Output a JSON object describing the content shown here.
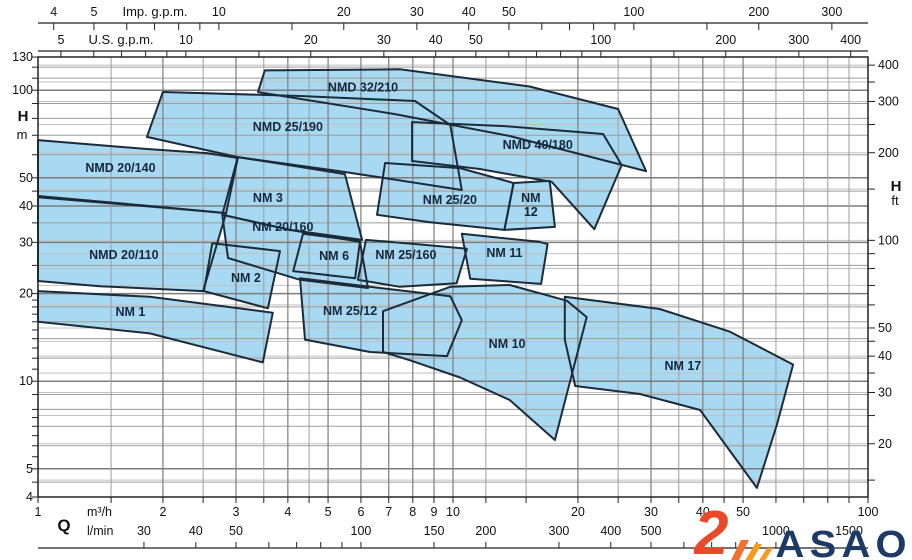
{
  "logo": {
    "brand": "ASAO",
    "numeral": "2",
    "color_navy": "#1d3a66",
    "color_orange": "#e8492b",
    "color_orange_light": "#f59c20"
  },
  "chart_data": {
    "type": "area",
    "title": "Pump selection chart NM / NMD series (head H vs flow Q, log-log)",
    "colors": {
      "region_fill": "#a7daf2",
      "region_stroke": "#1c2b3a",
      "label_color": "#16283e",
      "grid_major": "#7c7c7c",
      "grid_minor": "#9d9d9d",
      "grid_faint": "#c2c2c2",
      "axis_color": "#222222",
      "text_color": "#111111"
    },
    "axes": {
      "top1": {
        "label": "Imp. g.p.m.",
        "factor_m3h": 0.27277,
        "ticks": [
          4,
          5,
          6,
          7,
          8,
          9,
          10,
          15,
          20,
          30,
          40,
          50,
          60,
          70,
          80,
          90,
          100,
          150,
          200,
          300
        ],
        "labeled": [
          4,
          5,
          10,
          20,
          30,
          40,
          50,
          100,
          200,
          300
        ]
      },
      "top2": {
        "label": "U.S. g.p.m.",
        "factor_m3h": 0.22712,
        "ticks": [
          5,
          6,
          7,
          8,
          9,
          10,
          15,
          20,
          30,
          40,
          50,
          60,
          70,
          80,
          90,
          100,
          150,
          200,
          300,
          400
        ],
        "labeled": [
          5,
          10,
          20,
          30,
          40,
          50,
          100,
          200,
          300,
          400
        ]
      },
      "left": {
        "label": "H",
        "unit": "m",
        "range": [
          4,
          130
        ],
        "labeled": [
          130,
          100,
          50,
          40,
          30,
          20,
          10,
          5,
          4
        ],
        "ticks": [
          4,
          4.5,
          5,
          5.5,
          6,
          6.5,
          7,
          7.5,
          8,
          9,
          10,
          11,
          12,
          13,
          14,
          15,
          16,
          17,
          18,
          19,
          20,
          25,
          30,
          35,
          40,
          45,
          50,
          60,
          70,
          80,
          90,
          100,
          110,
          120,
          130
        ]
      },
      "right": {
        "label": "H",
        "unit": "ft",
        "factor_m": 0.3048,
        "labeled": [
          400,
          300,
          200,
          100,
          50,
          40,
          30,
          20
        ],
        "ticks": [
          15,
          20,
          25,
          30,
          35,
          40,
          45,
          50,
          60,
          70,
          80,
          90,
          100,
          150,
          200,
          250,
          300,
          350,
          400
        ]
      },
      "bottom1": {
        "label": "Q",
        "unit": "m³/h",
        "range": [
          1,
          100
        ],
        "labeled": [
          1,
          2,
          3,
          4,
          5,
          6,
          7,
          8,
          9,
          10,
          20,
          30,
          40,
          50,
          100
        ]
      },
      "bottom2": {
        "unit": "l/min",
        "factor_m3h": 0.06,
        "ticks": [
          30,
          40,
          50,
          60,
          70,
          80,
          90,
          100,
          150,
          200,
          300,
          400,
          500,
          600,
          700,
          800,
          900,
          1000,
          1500
        ],
        "labeled": [
          30,
          40,
          50,
          100,
          150,
          200,
          300,
          400,
          500,
          1000,
          1500
        ]
      }
    },
    "grid": {
      "q_major": [
        1,
        2,
        3,
        4,
        5,
        6,
        7,
        8,
        9,
        10,
        20,
        30,
        40,
        50,
        100
      ],
      "q_minor": [
        1.5,
        2.5,
        3.5,
        4.5,
        12,
        15,
        25,
        35,
        45,
        60,
        70,
        80,
        90
      ],
      "h_major": [
        4,
        5,
        10,
        20,
        30,
        40,
        50,
        100
      ],
      "h_minor": [
        4.5,
        6,
        7,
        8,
        9,
        12,
        14,
        16,
        18,
        25,
        35,
        45,
        60,
        70,
        80,
        90,
        110,
        120
      ],
      "ft_lines": [
        15,
        20,
        25,
        30,
        35,
        40,
        45,
        50,
        60,
        70,
        80,
        90,
        100,
        150,
        200,
        250,
        300,
        350,
        400
      ]
    },
    "regions": [
      {
        "label": "NMD 20/140",
        "label_q": 1.58,
        "label_h": 54.0,
        "points": [
          [
            1.0,
            67.4
          ],
          [
            1.83,
            62.8
          ],
          [
            2.55,
            60.8
          ],
          [
            3.03,
            58.5
          ],
          [
            2.84,
            37.8
          ],
          [
            1.86,
            40.0
          ],
          [
            1.0,
            43.3
          ]
        ]
      },
      {
        "label": "NMD 20/110",
        "label_q": 1.61,
        "label_h": 27.1,
        "points": [
          [
            1.0,
            42.9
          ],
          [
            2.3,
            38.8
          ],
          [
            2.84,
            37.8
          ],
          [
            2.5,
            20.4
          ],
          [
            1.41,
            21.2
          ],
          [
            1.0,
            22.1
          ]
        ]
      },
      {
        "label": "NM 1",
        "label_q": 1.67,
        "label_h": 17.3,
        "points": [
          [
            1.0,
            20.4
          ],
          [
            1.86,
            19.5
          ],
          [
            3.68,
            17.2
          ],
          [
            3.48,
            11.6
          ],
          [
            1.86,
            14.6
          ],
          [
            1.0,
            16.0
          ]
        ]
      },
      {
        "label": "NMD 25/190",
        "label_q": 4.0,
        "label_h": 74.7,
        "points": [
          [
            2.0,
            98.6
          ],
          [
            4.28,
            95.5
          ],
          [
            8.1,
            91.8
          ],
          [
            9.85,
            75.9
          ],
          [
            10.5,
            45.4
          ],
          [
            5.34,
            52.7
          ],
          [
            3.03,
            58.9
          ],
          [
            1.83,
            69.1
          ]
        ]
      },
      {
        "label": "NMD 32/210",
        "label_q": 6.07,
        "label_h": 102,
        "points": [
          [
            3.52,
            117
          ],
          [
            7.45,
            118
          ],
          [
            15.3,
            103
          ],
          [
            25.0,
            86.2
          ],
          [
            29.2,
            52.7
          ],
          [
            13.7,
            69.6
          ],
          [
            7.25,
            82.8
          ],
          [
            3.39,
            98.5
          ]
        ]
      },
      {
        "label": "NMD 40/180",
        "label_q": 16.0,
        "label_h": 64.8,
        "points": [
          [
            7.97,
            77.7
          ],
          [
            13.3,
            75.3
          ],
          [
            23.0,
            70.7
          ],
          [
            25.5,
            55.3
          ],
          [
            21.9,
            33.3
          ],
          [
            17.3,
            48.4
          ],
          [
            11.6,
            53.6
          ],
          [
            7.97,
            57.1
          ]
        ]
      },
      {
        "label": "NM 3",
        "label_q": 3.58,
        "label_h": 42.6,
        "points": [
          [
            3.03,
            58.9
          ],
          [
            4.28,
            54.5
          ],
          [
            5.49,
            51.5
          ],
          [
            6.04,
            30.6
          ],
          [
            4.05,
            33.1
          ],
          [
            2.78,
            37.3
          ]
        ]
      },
      {
        "label": "NM 2",
        "label_q": 3.17,
        "label_h": 22.6,
        "points": [
          [
            2.63,
            29.8
          ],
          [
            3.83,
            28.0
          ],
          [
            3.58,
            17.8
          ],
          [
            2.51,
            20.4
          ]
        ]
      },
      {
        "label": "NM 20/160",
        "label_q": 3.89,
        "label_h": 33.9,
        "points": [
          [
            2.78,
            37.3
          ],
          [
            4.05,
            33.1
          ],
          [
            5.97,
            30.1
          ],
          [
            6.24,
            20.9
          ],
          [
            4.28,
            22.3
          ],
          [
            2.87,
            26.5
          ]
        ]
      },
      {
        "label": "NM 6",
        "label_q": 5.17,
        "label_h": 26.9,
        "points": [
          [
            4.35,
            32.1
          ],
          [
            5.97,
            30.3
          ],
          [
            5.81,
            22.6
          ],
          [
            4.12,
            23.9
          ]
        ]
      },
      {
        "label": "NM 25/160",
        "label_q": 7.7,
        "label_h": 27.1,
        "points": [
          [
            6.17,
            30.6
          ],
          [
            8.56,
            29.4
          ],
          [
            10.8,
            28.5
          ],
          [
            10.2,
            21.7
          ],
          [
            7.45,
            21.1
          ],
          [
            5.9,
            22.3
          ]
        ]
      },
      {
        "label": "NM 11",
        "label_q": 13.3,
        "label_h": 27.6,
        "points": [
          [
            10.5,
            32.1
          ],
          [
            16.2,
            30.1
          ],
          [
            16.9,
            29.6
          ],
          [
            16.3,
            21.6
          ],
          [
            11.0,
            22.5
          ]
        ]
      },
      {
        "label": "NM 25/20",
        "label_q": 9.83,
        "label_h": 42.0,
        "points": [
          [
            6.86,
            56.2
          ],
          [
            10.4,
            54.0
          ],
          [
            14.0,
            48.0
          ],
          [
            13.3,
            33.1
          ],
          [
            8.8,
            35.2
          ],
          [
            6.56,
            37.3
          ]
        ]
      },
      {
        "label": "NM 12",
        "label_lines": [
          "NM",
          "12"
        ],
        "label_q": 15.4,
        "label_h": 40.3,
        "points": [
          [
            14.0,
            48.0
          ],
          [
            17.1,
            48.8
          ],
          [
            17.6,
            33.9
          ],
          [
            13.3,
            33.1
          ]
        ]
      },
      {
        "label": "NM 25/12",
        "label_q": 5.65,
        "label_h": 17.4,
        "points": [
          [
            4.28,
            22.6
          ],
          [
            6.67,
            20.9
          ],
          [
            9.85,
            19.6
          ],
          [
            10.5,
            16.2
          ],
          [
            9.67,
            12.2
          ],
          [
            6.31,
            12.6
          ],
          [
            4.4,
            13.9
          ]
        ]
      },
      {
        "label": "NM 10",
        "label_q": 13.5,
        "label_h": 13.4,
        "points": [
          [
            6.78,
            17.4
          ],
          [
            9.85,
            21.1
          ],
          [
            13.7,
            21.4
          ],
          [
            18.8,
            18.9
          ],
          [
            21.0,
            16.6
          ],
          [
            17.6,
            6.28
          ],
          [
            13.7,
            8.62
          ],
          [
            10.4,
            10.3
          ],
          [
            7.88,
            11.8
          ],
          [
            6.78,
            12.6
          ]
        ]
      },
      {
        "label": "NM 17",
        "label_q": 35.8,
        "label_h": 11.3,
        "points": [
          [
            18.6,
            19.5
          ],
          [
            31.5,
            17.7
          ],
          [
            46.5,
            14.8
          ],
          [
            66.0,
            11.4
          ],
          [
            60.3,
            7.07
          ],
          [
            54.0,
            4.3
          ],
          [
            39.4,
            7.96
          ],
          [
            28.2,
            9.04
          ],
          [
            19.7,
            9.63
          ],
          [
            18.6,
            13.9
          ]
        ]
      }
    ]
  }
}
